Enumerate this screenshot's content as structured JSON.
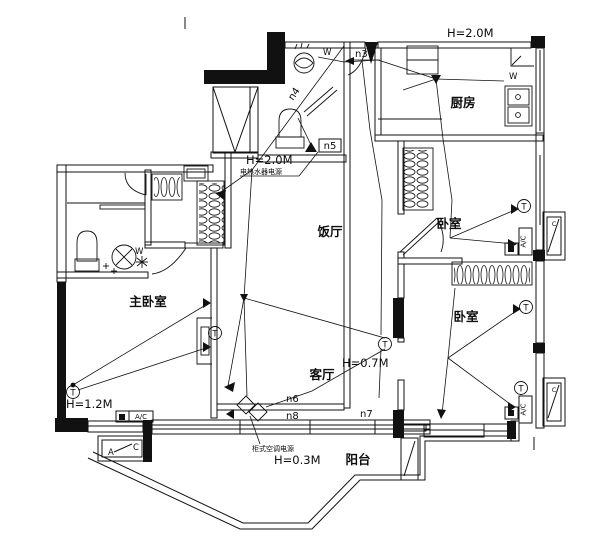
{
  "rooms": {
    "kitchen": "厨房",
    "bedroom_top": "卧室",
    "bedroom_bottom": "卧室",
    "master": "主卧室",
    "dining": "饭厅",
    "living": "客厅",
    "balcony": "阳台"
  },
  "annotations": {
    "h_top": "H=2.0M",
    "h_heater": "H=2.0M",
    "heater_note": "电热水器电源",
    "h_corridor": "H=0.7M",
    "h_master": "H=1.2M",
    "h_balcony": "H=0.3M",
    "balcony_note": "柜式空调电源"
  },
  "circuits": {
    "n3": "n3",
    "n4": "n4",
    "n5": "n5",
    "n6": "n6",
    "n7": "n7",
    "n8": "n8"
  },
  "devices": {
    "ac": "A/C",
    "wall_lamp": "W",
    "socket": "T",
    "outdoor_a": "A",
    "outdoor_c": "C"
  },
  "colors": {
    "ink": "#111111",
    "paper": "#ffffff"
  }
}
